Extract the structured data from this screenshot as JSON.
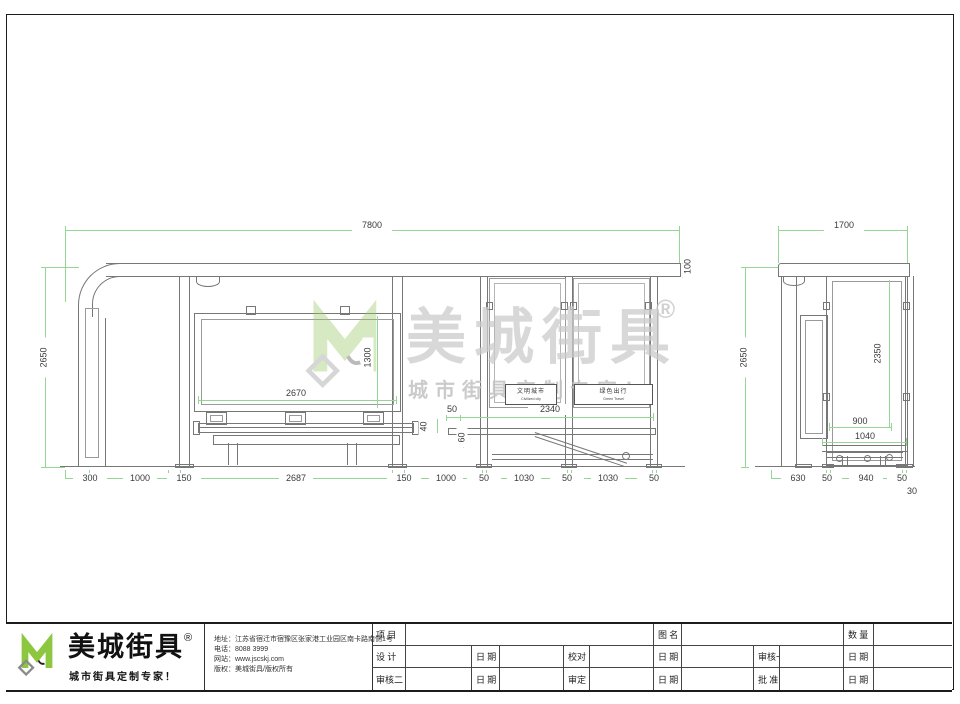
{
  "watermark": {
    "brand": "美城街具",
    "reg": "®",
    "tagline": "城市街具定制专家！"
  },
  "front_view": {
    "dim_top": "7800",
    "dim_left": "2650",
    "dim_roof_edge": "100",
    "dim_board_w": "2670",
    "dim_board_h": "1300",
    "dim_50_small": "50",
    "dim_rail": "2340",
    "dim_40": "40",
    "dim_60": "60",
    "bottom_dims": [
      "300",
      "1000",
      "150",
      "2687",
      "150",
      "1000",
      "50",
      "1030",
      "50",
      "1030",
      "50"
    ],
    "panel1": {
      "cn": "文明城市",
      "en": "Civilized city"
    },
    "panel2": {
      "cn": "绿色出行",
      "en": "Green Travel"
    }
  },
  "side_view": {
    "dim_top": "1700",
    "dim_left": "2650",
    "dim_height": "2350",
    "dim_900": "900",
    "dim_1040": "1040",
    "bottom_dims": [
      "630",
      "50",
      "940",
      "50"
    ],
    "dim_30": "30"
  },
  "titleblock": {
    "brand": "美城街具",
    "reg": "®",
    "tagline": "城市街具定制专家！",
    "info": [
      "地址：江苏省宿迁市宿豫区张家港工业园区南卡路南侧1号",
      "电话：8088 3999",
      "网站：www.jscskj.com",
      "版权：美城街具/版权所有"
    ],
    "table": {
      "row1": [
        "项 目",
        "图 名",
        "数 量"
      ],
      "row2": [
        "设 计",
        "日 期",
        "校对",
        "日 期",
        "审核一",
        "日 期"
      ],
      "row3": [
        "审核二",
        "日 期",
        "审定",
        "日 期",
        "批 准",
        "日 期"
      ]
    }
  },
  "colors": {
    "dimension_green": "#94d694",
    "drawing_gray": "#777777",
    "brand_green": "#8dc63f"
  }
}
